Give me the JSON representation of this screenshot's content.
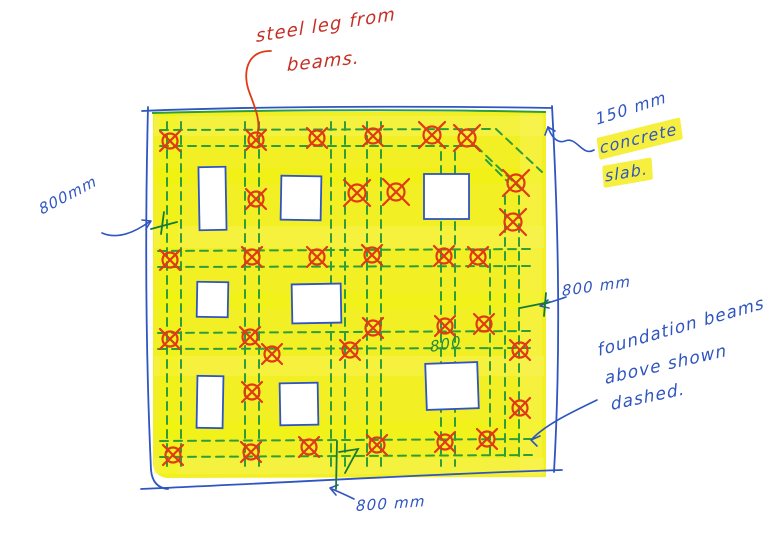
{
  "annotations": {
    "steel_leg_note": {
      "line1": "steel leg from",
      "line2": "beams."
    },
    "slab_note": {
      "line1": "150 mm",
      "line2": "concrete",
      "line3": "slab."
    },
    "left_dim": {
      "label": "800mm"
    },
    "right_dim": {
      "label": "800 mm"
    },
    "center_dim": {
      "label": "800"
    },
    "bottom_dim": {
      "label": "800 mm"
    },
    "foundation_note": {
      "line1": "foundation beams",
      "line2": "above shown",
      "line3": "dashed."
    }
  },
  "colors": {
    "highlighter": "#f2ee12",
    "highlighter_light": "#f9f65f",
    "pen_blue": "#2f55c0",
    "pen_green": "#2f9e3a",
    "pen_red": "#df3a15",
    "text_red": "#c43026",
    "text_blue": "#2f55c0",
    "text_green": "#1f8c3c",
    "paper": "#ffffff"
  },
  "diagram": {
    "slab": {
      "x": 150,
      "y": 110,
      "w": 398,
      "h": 368
    },
    "openings": [
      {
        "x": 199,
        "y": 167,
        "w": 27,
        "h": 63,
        "r": -1
      },
      {
        "x": 281,
        "y": 176,
        "w": 40,
        "h": 44,
        "r": 1
      },
      {
        "x": 424,
        "y": 174,
        "w": 45,
        "h": 45,
        "r": 0
      },
      {
        "x": 197,
        "y": 282,
        "w": 31,
        "h": 35,
        "r": 1
      },
      {
        "x": 292,
        "y": 284,
        "w": 49,
        "h": 39,
        "r": -1
      },
      {
        "x": 197,
        "y": 376,
        "w": 26,
        "h": 52,
        "r": 1
      },
      {
        "x": 280,
        "y": 383,
        "w": 38,
        "h": 42,
        "r": -1
      },
      {
        "x": 426,
        "y": 363,
        "w": 52,
        "h": 46,
        "r": -2
      }
    ],
    "markers": [
      {
        "x": 170,
        "y": 141
      },
      {
        "x": 256,
        "y": 140
      },
      {
        "x": 317,
        "y": 138
      },
      {
        "x": 373,
        "y": 136
      },
      {
        "x": 432,
        "y": 135,
        "big": true
      },
      {
        "x": 467,
        "y": 138,
        "big": true
      },
      {
        "x": 516,
        "y": 183,
        "big": true
      },
      {
        "x": 513,
        "y": 222,
        "big": true
      },
      {
        "x": 170,
        "y": 260
      },
      {
        "x": 252,
        "y": 257
      },
      {
        "x": 317,
        "y": 257
      },
      {
        "x": 372,
        "y": 255
      },
      {
        "x": 444,
        "y": 256
      },
      {
        "x": 478,
        "y": 257
      },
      {
        "x": 357,
        "y": 193,
        "big": true
      },
      {
        "x": 396,
        "y": 192,
        "big": true
      },
      {
        "x": 256,
        "y": 199
      },
      {
        "x": 170,
        "y": 339
      },
      {
        "x": 250,
        "y": 337
      },
      {
        "x": 272,
        "y": 354
      },
      {
        "x": 350,
        "y": 350
      },
      {
        "x": 373,
        "y": 328
      },
      {
        "x": 445,
        "y": 326
      },
      {
        "x": 484,
        "y": 324
      },
      {
        "x": 520,
        "y": 350
      },
      {
        "x": 252,
        "y": 392
      },
      {
        "x": 520,
        "y": 408
      },
      {
        "x": 173,
        "y": 455
      },
      {
        "x": 251,
        "y": 452
      },
      {
        "x": 309,
        "y": 447
      },
      {
        "x": 377,
        "y": 445
      },
      {
        "x": 445,
        "y": 442
      },
      {
        "x": 487,
        "y": 439
      }
    ],
    "beams": {
      "h": [
        [
          160,
          130,
          496,
          129
        ],
        [
          160,
          146,
          476,
          146
        ],
        [
          158,
          251,
          532,
          249
        ],
        [
          158,
          267,
          532,
          266
        ],
        [
          158,
          333,
          530,
          331
        ],
        [
          158,
          349,
          530,
          348
        ],
        [
          160,
          441,
          532,
          439
        ],
        [
          160,
          457,
          532,
          455
        ]
      ],
      "v": [
        [
          167,
          122,
          167,
          466
        ],
        [
          181,
          122,
          181,
          466
        ],
        [
          245,
          122,
          245,
          466
        ],
        [
          259,
          122,
          259,
          466
        ],
        [
          331,
          122,
          331,
          466
        ],
        [
          345,
          122,
          345,
          466
        ],
        [
          367,
          122,
          367,
          466
        ],
        [
          381,
          122,
          381,
          466
        ],
        [
          441,
          152,
          441,
          466
        ],
        [
          455,
          152,
          455,
          466
        ],
        [
          490,
          250,
          490,
          458
        ],
        [
          505,
          196,
          505,
          462
        ],
        [
          519,
          196,
          519,
          462
        ]
      ],
      "diag": [
        [
          496,
          129,
          542,
          172
        ],
        [
          476,
          146,
          520,
          188
        ],
        [
          486,
          160,
          508,
          182
        ]
      ]
    }
  }
}
